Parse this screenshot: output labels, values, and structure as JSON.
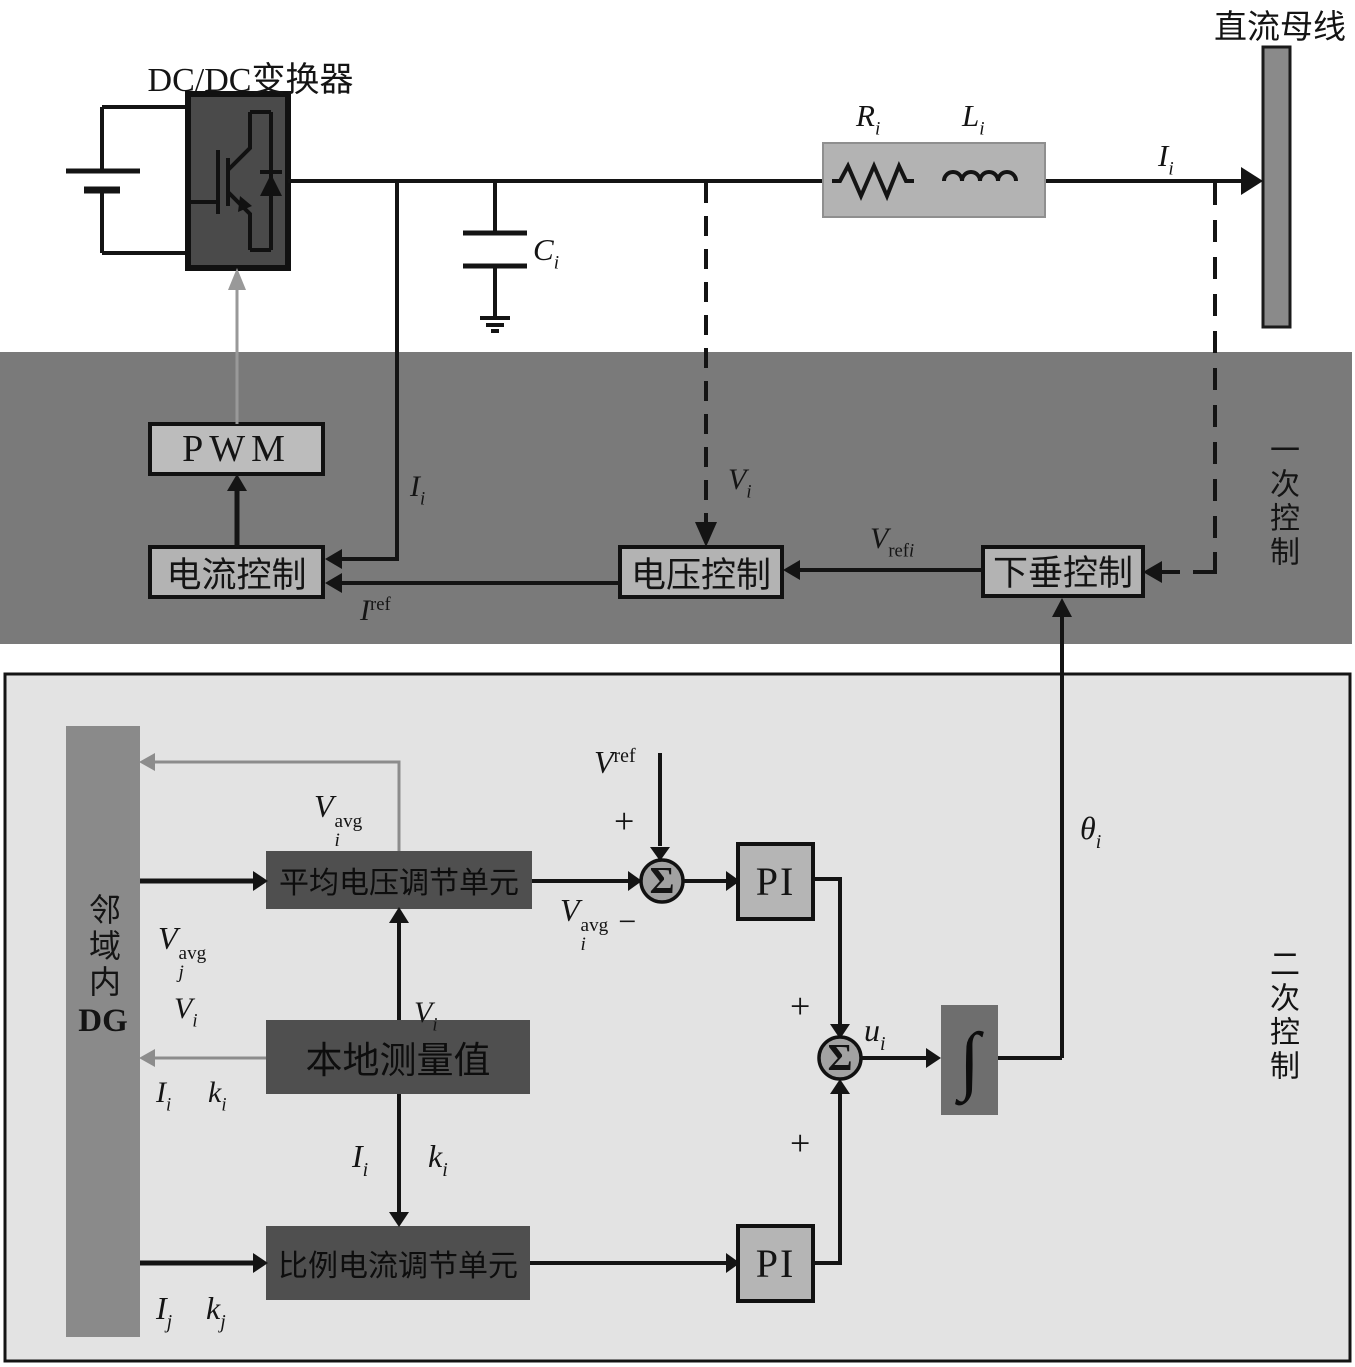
{
  "labels": {
    "dc_bus": "直流母线",
    "converter": "DC/DC变换器",
    "primary_section": "一次控制",
    "secondary_section": "二次控制",
    "pwm": "PWM",
    "current_control": "电流控制",
    "voltage_control": "电压控制",
    "droop_control": "下垂控制",
    "neighbor_cjk": "邻域内",
    "neighbor_latin": "DG",
    "avg_voltage_unit": "平均电压调节单元",
    "local_measurement": "本地测量值",
    "prop_current_unit": "比例电流调节单元",
    "pi": "PI",
    "sum": "Σ",
    "integral": "∫",
    "plus": "+",
    "minus": "−"
  },
  "math": {
    "Ci": {
      "base": "C",
      "sub": "i"
    },
    "Ri": {
      "base": "R",
      "sub": "i"
    },
    "Li": {
      "base": "L",
      "sub": "i"
    },
    "Ii": {
      "base": "I",
      "sub": "i"
    },
    "Vi": {
      "base": "V",
      "sub": "i"
    },
    "Ij": {
      "base": "I",
      "sub": "j"
    },
    "ki": {
      "base": "k",
      "sub": "i"
    },
    "kj": {
      "base": "k",
      "sub": "j"
    },
    "ui": {
      "base": "u",
      "sub": "i"
    },
    "thetai": {
      "base": "θ",
      "sub": "i"
    },
    "Iref": {
      "base": "I",
      "sup": "ref"
    },
    "Vref": {
      "base": "V",
      "sup": "ref"
    },
    "Vrefi": {
      "base": "V",
      "subroman": "ref",
      "subitalic": "i"
    },
    "Viavg": {
      "base": "V",
      "sup": "avg",
      "sub": "i"
    },
    "Vjavg": {
      "base": "V",
      "sup": "avg",
      "sub": "j"
    }
  },
  "colors": {
    "band": "#7a7a7a",
    "panel": "#e3e3e3",
    "dark_box": "#4f4f4f",
    "light_box": "#b5b5b5",
    "bar": "#8a8a8a",
    "integrator_box": "#6e6e6e",
    "gray_line": "#8c8c8c",
    "black": "#141414"
  }
}
